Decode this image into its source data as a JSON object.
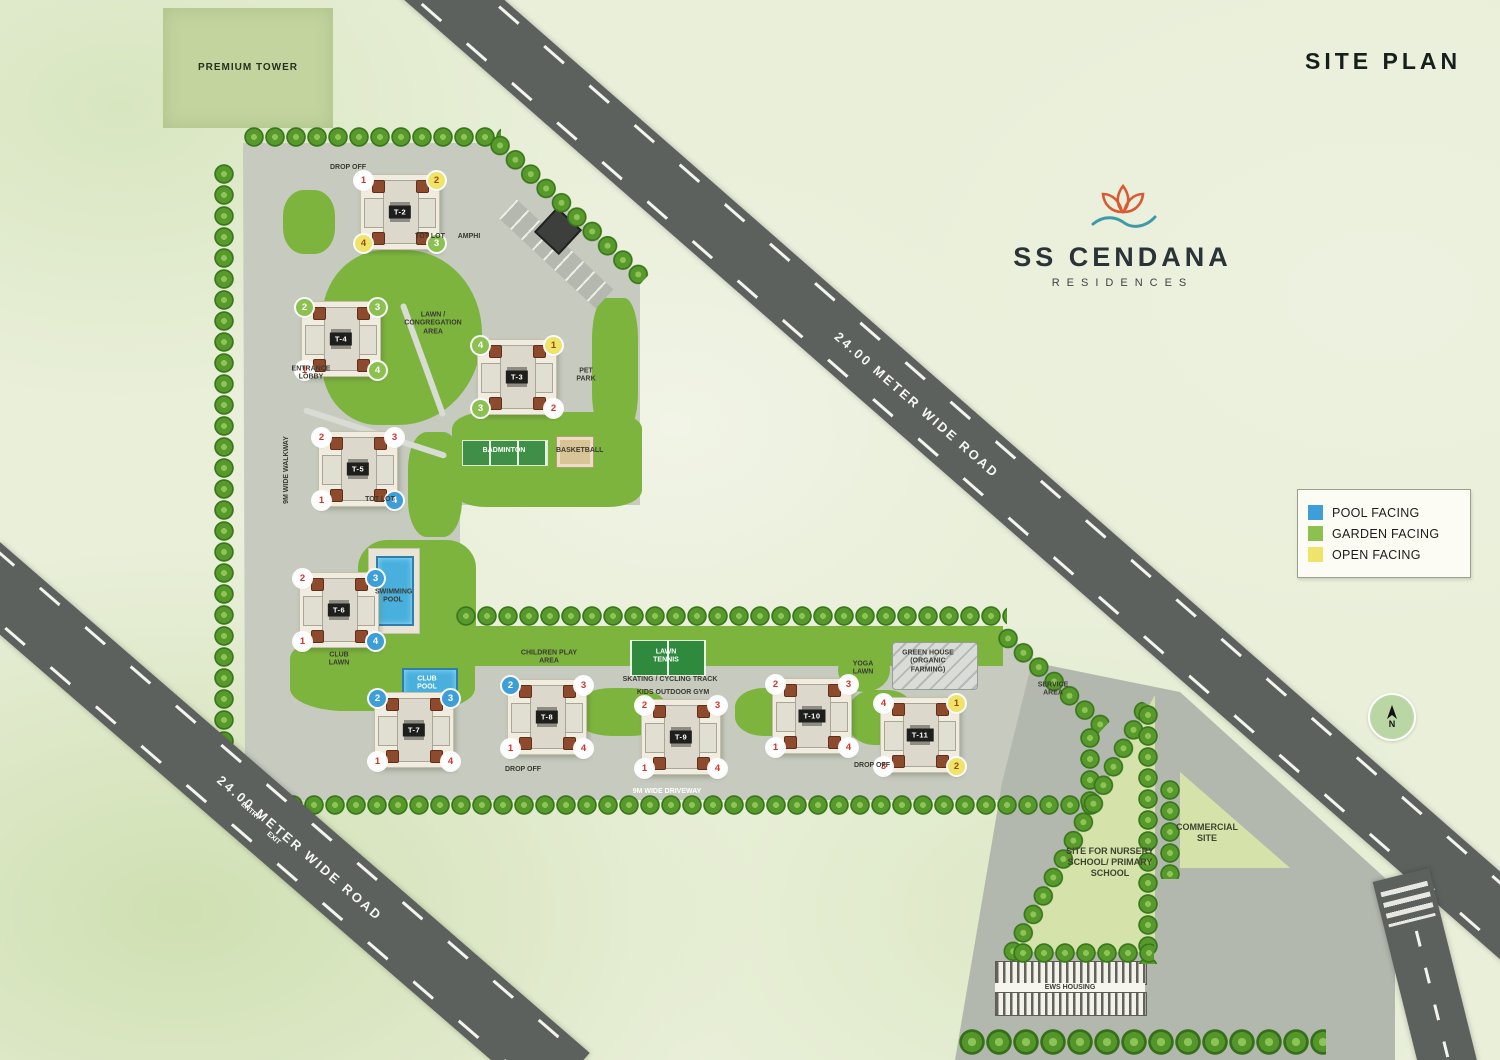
{
  "title": "SITE PLAN",
  "brand": {
    "name": "SS CENDANA",
    "sub": "RESIDENCES"
  },
  "premium": {
    "label": "PREMIUM TOWER"
  },
  "compass": {
    "label": "N"
  },
  "roads": {
    "top_label": "24.00 METER WIDE ROAD",
    "bottom_label": "24.00 METER WIDE ROAD"
  },
  "colors": {
    "pool": "#3d9ed8",
    "garden": "#8cc152",
    "open": "#efe469",
    "white": "#ffffff",
    "road": "#5d615e"
  },
  "legend": {
    "items": [
      {
        "key": "pool",
        "label": "POOL FACING"
      },
      {
        "key": "garden",
        "label": "GARDEN FACING"
      },
      {
        "key": "open",
        "label": "OPEN FACING"
      }
    ]
  },
  "site": {
    "towers": [
      {
        "id": "T-2",
        "x": 400,
        "y": 212,
        "circles": [
          {
            "pos": "nw",
            "n": "1",
            "color": "white"
          },
          {
            "pos": "ne",
            "n": "2",
            "color": "open"
          },
          {
            "pos": "sw",
            "n": "4",
            "color": "open"
          },
          {
            "pos": "se",
            "n": "3",
            "color": "garden"
          }
        ]
      },
      {
        "id": "T-4",
        "x": 341,
        "y": 339,
        "circles": [
          {
            "pos": "nw",
            "n": "2",
            "color": "garden"
          },
          {
            "pos": "ne",
            "n": "3",
            "color": "garden"
          },
          {
            "pos": "sw",
            "n": "1",
            "color": "white"
          },
          {
            "pos": "se",
            "n": "4",
            "color": "garden"
          }
        ]
      },
      {
        "id": "T-3",
        "x": 517,
        "y": 377,
        "circles": [
          {
            "pos": "nw",
            "n": "4",
            "color": "garden"
          },
          {
            "pos": "ne",
            "n": "1",
            "color": "open"
          },
          {
            "pos": "sw",
            "n": "3",
            "color": "garden"
          },
          {
            "pos": "se",
            "n": "2",
            "color": "white"
          }
        ]
      },
      {
        "id": "T-5",
        "x": 358,
        "y": 469,
        "circles": [
          {
            "pos": "nw",
            "n": "2",
            "color": "white"
          },
          {
            "pos": "ne",
            "n": "3",
            "color": "white"
          },
          {
            "pos": "sw",
            "n": "1",
            "color": "white"
          },
          {
            "pos": "se",
            "n": "4",
            "color": "pool"
          }
        ]
      },
      {
        "id": "T-6",
        "x": 339,
        "y": 610,
        "circles": [
          {
            "pos": "nw",
            "n": "2",
            "color": "white"
          },
          {
            "pos": "ne",
            "n": "3",
            "color": "pool"
          },
          {
            "pos": "sw",
            "n": "1",
            "color": "white"
          },
          {
            "pos": "se",
            "n": "4",
            "color": "pool"
          }
        ]
      },
      {
        "id": "T-7",
        "x": 414,
        "y": 730,
        "circles": [
          {
            "pos": "nw",
            "n": "2",
            "color": "pool"
          },
          {
            "pos": "ne",
            "n": "3",
            "color": "pool"
          },
          {
            "pos": "sw",
            "n": "1",
            "color": "white"
          },
          {
            "pos": "se",
            "n": "4",
            "color": "white"
          }
        ]
      },
      {
        "id": "T-8",
        "x": 547,
        "y": 717,
        "circles": [
          {
            "pos": "nw",
            "n": "2",
            "color": "pool"
          },
          {
            "pos": "ne",
            "n": "3",
            "color": "white"
          },
          {
            "pos": "sw",
            "n": "1",
            "color": "white"
          },
          {
            "pos": "se",
            "n": "4",
            "color": "white"
          }
        ]
      },
      {
        "id": "T-9",
        "x": 681,
        "y": 737,
        "circles": [
          {
            "pos": "nw",
            "n": "2",
            "color": "white"
          },
          {
            "pos": "ne",
            "n": "3",
            "color": "white"
          },
          {
            "pos": "sw",
            "n": "1",
            "color": "white"
          },
          {
            "pos": "se",
            "n": "4",
            "color": "white"
          }
        ]
      },
      {
        "id": "T-10",
        "x": 812,
        "y": 716,
        "circles": [
          {
            "pos": "nw",
            "n": "2",
            "color": "white"
          },
          {
            "pos": "ne",
            "n": "3",
            "color": "white"
          },
          {
            "pos": "sw",
            "n": "1",
            "color": "white"
          },
          {
            "pos": "se",
            "n": "4",
            "color": "white"
          }
        ]
      },
      {
        "id": "T-11",
        "x": 920,
        "y": 735,
        "circles": [
          {
            "pos": "nw",
            "n": "4",
            "color": "white"
          },
          {
            "pos": "ne",
            "n": "1",
            "color": "open"
          },
          {
            "pos": "sw",
            "n": "3",
            "color": "white"
          },
          {
            "pos": "se",
            "n": "2",
            "color": "open"
          }
        ]
      }
    ],
    "labels": [
      {
        "t": "DROP OFF",
        "x": 348,
        "y": 168
      },
      {
        "t": "TOT LOT",
        "x": 430,
        "y": 237
      },
      {
        "t": "AMPHI",
        "x": 469,
        "y": 237
      },
      {
        "t": "ENTRANCE LOBBY",
        "x": 311,
        "y": 374,
        "w": 42
      },
      {
        "t": "LAWN / CONGREGATION AREA",
        "x": 433,
        "y": 324,
        "w": 64
      },
      {
        "t": "PET PARK",
        "x": 586,
        "y": 376,
        "w": 26
      },
      {
        "t": "BADMINTON",
        "x": 504,
        "y": 451,
        "cls": "white"
      },
      {
        "t": "BASKETBALL",
        "x": 574,
        "y": 451,
        "w": 36
      },
      {
        "t": "TOT LOT",
        "x": 380,
        "y": 500
      },
      {
        "t": "9M WIDE WALKWAY",
        "x": 287,
        "y": 470,
        "rot": -90
      },
      {
        "t": "SWIMMING POOL",
        "x": 393,
        "y": 597,
        "w": 36
      },
      {
        "t": "CLUB LAWN",
        "x": 339,
        "y": 660,
        "w": 32
      },
      {
        "t": "CLUB POOL",
        "x": 427,
        "y": 684,
        "w": 30,
        "cls": "white"
      },
      {
        "t": "CHILDREN PLAY AREA",
        "x": 549,
        "y": 658,
        "w": 58
      },
      {
        "t": "LAWN TENNIS",
        "x": 666,
        "y": 657,
        "w": 44,
        "cls": "white"
      },
      {
        "t": "SKATING / CYCLING TRACK",
        "x": 670,
        "y": 680
      },
      {
        "t": "KIDS OUTDOOR GYM",
        "x": 673,
        "y": 693
      },
      {
        "t": "YOGA LAWN",
        "x": 863,
        "y": 669,
        "w": 30
      },
      {
        "t": "GREEN HOUSE (ORGANIC FARMING)",
        "x": 928,
        "y": 662,
        "w": 64
      },
      {
        "t": "9M WIDE DRIVEWAY",
        "x": 667,
        "y": 792,
        "cls": "white"
      },
      {
        "t": "SERVICE AREA",
        "x": 1053,
        "y": 690,
        "w": 42
      },
      {
        "t": "ENTRY",
        "x": 250,
        "y": 812,
        "rot": 41,
        "cls": "white"
      },
      {
        "t": "EXIT",
        "x": 273,
        "y": 839,
        "rot": 41,
        "cls": "white"
      },
      {
        "t": "DROP OFF",
        "x": 523,
        "y": 770
      },
      {
        "t": "DROP OFF",
        "x": 872,
        "y": 766
      },
      {
        "t": "SITE FOR NURSERY SCHOOL/ PRIMARY SCHOOL",
        "x": 1110,
        "y": 862,
        "w": 92,
        "cls": "big"
      },
      {
        "t": "COMMERCIAL SITE",
        "x": 1207,
        "y": 833,
        "w": 62,
        "cls": "big"
      },
      {
        "t": "EWS HOUSING",
        "x": 1070,
        "y": 988
      }
    ]
  }
}
